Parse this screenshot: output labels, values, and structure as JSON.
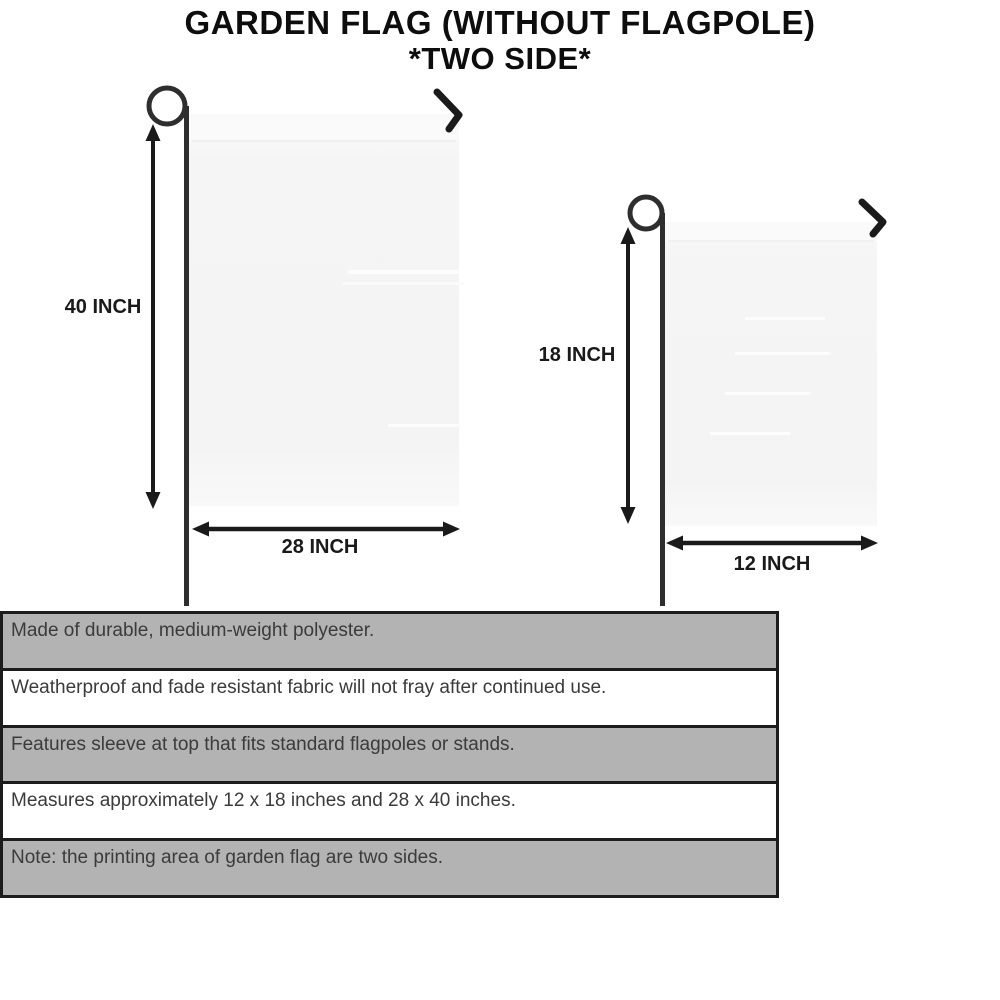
{
  "title": {
    "line1": "GARDEN FLAG (WITHOUT FLAGPOLE)",
    "line2": "*TWO SIDE*"
  },
  "flags": {
    "large": {
      "height_label": "40 INCH",
      "width_label": "28 INCH"
    },
    "small": {
      "height_label": "18 INCH",
      "width_label": "12 INCH"
    }
  },
  "features": {
    "rows": [
      {
        "text": "Made of durable, medium-weight polyester.",
        "shaded": true
      },
      {
        "text": "Weatherproof and fade resistant fabric will not fray after continued use.",
        "shaded": false
      },
      {
        "text": "Features sleeve at top that fits standard flagpoles or stands.",
        "shaded": true
      },
      {
        "text": "Measures approximately 12 x 18 inches and 28 x 40 inches.",
        "shaded": false
      },
      {
        "text": "Note: the printing area of garden flag are two sides.",
        "shaded": true
      }
    ]
  },
  "colors": {
    "background": "#ffffff",
    "title_text": "#0d0d0d",
    "dimension_text": "#1a1a1a",
    "arrow": "#1a1a1a",
    "pole": "#2e2e2e",
    "flag_fill": "#f6f6f6",
    "table_shaded_row": "#b3b3b3",
    "table_plain_row": "#ffffff",
    "table_border": "#1c1c1c",
    "table_text": "#3b3b3b"
  }
}
